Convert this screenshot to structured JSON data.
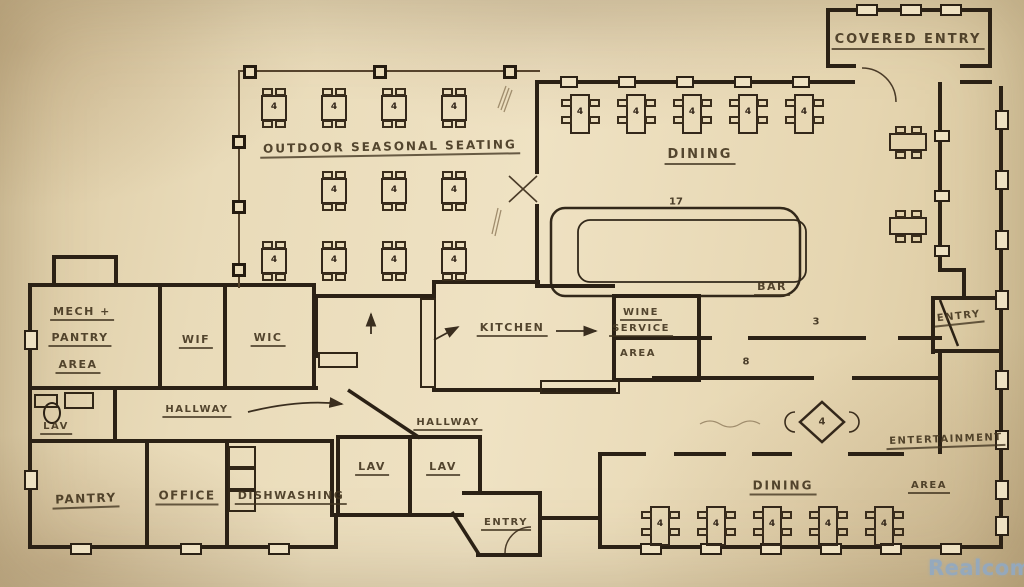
{
  "colors": {
    "paper": "#e9dbb9",
    "ink": "#2b2115",
    "pencil": "#43351f",
    "watermark": "#93a9c0"
  },
  "labels": {
    "covered_entry": "COVERED ENTRY",
    "dining_top": "DINING",
    "outdoor_seating": "OUTDOOR SEASONAL SEATING",
    "bar": "BAR",
    "kitchen": "KITCHEN",
    "wine_service": [
      "WINE",
      "SERVICE",
      "AREA"
    ],
    "mech_pantry": [
      "MECH +",
      "PANTRY",
      "AREA"
    ],
    "wif": "WIF",
    "wic": "WIC",
    "lav_small": "LAV",
    "hallway_west": "HALLWAY",
    "hallway_center": "HALLWAY",
    "pantry": "PANTRY",
    "office": "OFFICE",
    "dishwashing": "DISHWASHING",
    "lav_1": "LAV",
    "lav_2": "LAV",
    "entry_south": "ENTRY",
    "entry_east": "ENTRY",
    "dining_south": "DINING",
    "entertainment": [
      "ENTERTAINMENT",
      "AREA"
    ]
  },
  "annotations": {
    "seat_count": "4",
    "count_17": "17",
    "count_8": "8",
    "count_3": "3"
  },
  "watermark": "Realcomp"
}
